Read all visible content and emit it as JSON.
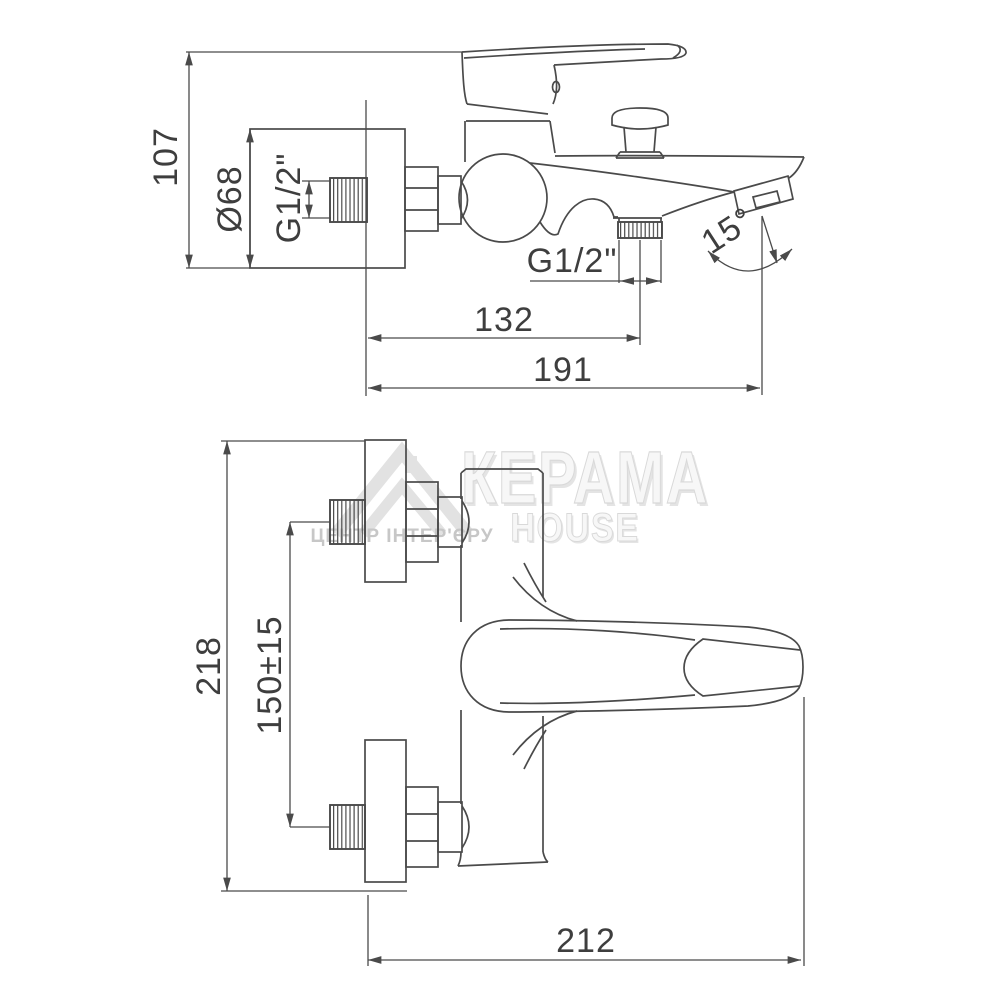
{
  "colors": {
    "line": "#4a4a4a",
    "dim_text": "#3e3e3e",
    "watermark_face": "#f7f7f7",
    "watermark_edge": "#d9d9d9",
    "watermark_shadow": "#e4e4e4",
    "tagline_gray": "#c7c7c7",
    "logo_gray": "#e2e2e2"
  },
  "watermark": {
    "brand_line1": "КЕРАМА",
    "brand_line2": "HOUSE",
    "tagline": "ЦЕНТР ІНТЕР'ЄРУ"
  },
  "side_view": {
    "overall_height": "107",
    "escutcheon_diameter": "Ø68",
    "inlet_thread": "G1/2\"",
    "shower_outlet_thread": "G1/2\"",
    "wall_to_shower_outlet": "132",
    "wall_to_spout_tip": "191",
    "spout_angle": "15°"
  },
  "plan_view": {
    "overall_height": "218",
    "inlet_spacing": "150±15",
    "overall_length": "212"
  }
}
